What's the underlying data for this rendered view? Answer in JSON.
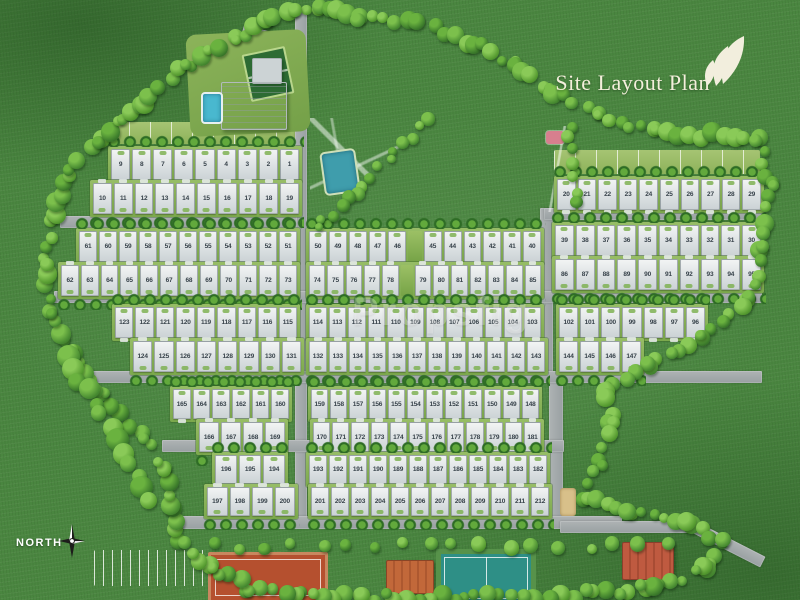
{
  "header": {
    "title": "Site Layout Plan"
  },
  "watermark": "Propsfig",
  "compass": {
    "label": "NORTH"
  },
  "colors": {
    "grass": "#4a8640",
    "road": "#9aa0a2",
    "plot": "#e3e8e9",
    "tree_dark": "#2f6a24",
    "tree_light": "#5fa83a",
    "title_text": "#f4efdc",
    "pool": "#49b8cf",
    "clay_court": "#b5502f",
    "green_court": "#2e8f86",
    "flower_bed": "#d77f8e"
  },
  "site": {
    "total_plots": 212,
    "rows": [
      {
        "x": 108,
        "y": 146,
        "w": 190,
        "h": 33,
        "dir": "up",
        "plots": [
          "9",
          "8",
          "7",
          "6",
          "5",
          "4",
          "3",
          "2",
          "1"
        ]
      },
      {
        "x": 90,
        "y": 180,
        "w": 208,
        "h": 33,
        "dir": "down",
        "plots": [
          "10",
          "11",
          "12",
          "13",
          "14",
          "15",
          "16",
          "17",
          "18",
          "19"
        ]
      },
      {
        "x": 554,
        "y": 176,
        "w": 206,
        "h": 33,
        "dir": "up",
        "plots": [
          "20",
          "21",
          "22",
          "23",
          "24",
          "25",
          "26",
          "27",
          "28",
          "29"
        ]
      },
      {
        "x": 76,
        "y": 228,
        "w": 220,
        "h": 33,
        "dir": "up",
        "plots": [
          "61",
          "60",
          "59",
          "58",
          "57",
          "56",
          "55",
          "54",
          "53",
          "52",
          "51"
        ]
      },
      {
        "x": 58,
        "y": 262,
        "w": 238,
        "h": 33,
        "dir": "down",
        "plots": [
          "62",
          "63",
          "64",
          "65",
          "66",
          "67",
          "68",
          "69",
          "70",
          "71",
          "72",
          "73"
        ]
      },
      {
        "x": 306,
        "y": 228,
        "w": 234,
        "h": 33,
        "dir": "up",
        "plots": [
          "50",
          "49",
          "48",
          "47",
          "46",
          null,
          "45",
          "44",
          "43",
          "42",
          "41",
          "40"
        ]
      },
      {
        "x": 306,
        "y": 262,
        "w": 234,
        "h": 33,
        "dir": "down",
        "plots": [
          "74",
          "75",
          "76",
          "77",
          "78",
          null,
          "79",
          "80",
          "81",
          "82",
          "83",
          "84",
          "85"
        ]
      },
      {
        "x": 552,
        "y": 222,
        "w": 208,
        "h": 33,
        "dir": "up",
        "plots": [
          "39",
          "38",
          "37",
          "36",
          "35",
          "34",
          "33",
          "32",
          "31",
          "30"
        ]
      },
      {
        "x": 552,
        "y": 256,
        "w": 208,
        "h": 33,
        "dir": "down",
        "plots": [
          "86",
          "87",
          "88",
          "89",
          "90",
          "91",
          "92",
          "93",
          "94",
          "95"
        ]
      },
      {
        "x": 112,
        "y": 304,
        "w": 184,
        "h": 33,
        "dir": "up",
        "plots": [
          "123",
          "122",
          "121",
          "120",
          "119",
          "118",
          "117",
          "116",
          "115"
        ]
      },
      {
        "x": 130,
        "y": 338,
        "w": 170,
        "h": 33,
        "dir": "down",
        "plots": [
          "124",
          "125",
          "126",
          "127",
          "128",
          "129",
          "130",
          "131"
        ]
      },
      {
        "x": 306,
        "y": 304,
        "w": 234,
        "h": 33,
        "dir": "up",
        "plots": [
          "114",
          "113",
          "112",
          "111",
          "110",
          "109",
          "108",
          "107",
          "106",
          "105",
          "104",
          "103"
        ]
      },
      {
        "x": 306,
        "y": 338,
        "w": 238,
        "h": 33,
        "dir": "down",
        "plots": [
          "132",
          "133",
          "134",
          "135",
          "136",
          "137",
          "138",
          "139",
          "140",
          "141",
          "142",
          "143"
        ]
      },
      {
        "x": 556,
        "y": 304,
        "w": 148,
        "h": 33,
        "dir": "up",
        "plots": [
          "102",
          "101",
          "100",
          "99",
          "98",
          "97",
          "96"
        ]
      },
      {
        "x": 556,
        "y": 338,
        "w": 84,
        "h": 33,
        "dir": "down",
        "plots": [
          "144",
          "145",
          "146",
          "147"
        ]
      },
      {
        "x": 170,
        "y": 386,
        "w": 118,
        "h": 32,
        "dir": "up",
        "plots": [
          "165",
          "164",
          "163",
          "162",
          "161",
          "160"
        ]
      },
      {
        "x": 196,
        "y": 419,
        "w": 88,
        "h": 32,
        "dir": "down",
        "plots": [
          "166",
          "167",
          "168",
          "169"
        ]
      },
      {
        "x": 308,
        "y": 386,
        "w": 230,
        "h": 32,
        "dir": "up",
        "plots": [
          "159",
          "158",
          "157",
          "156",
          "155",
          "154",
          "153",
          "152",
          "151",
          "150",
          "149",
          "148"
        ]
      },
      {
        "x": 310,
        "y": 419,
        "w": 230,
        "h": 32,
        "dir": "down",
        "plots": [
          "170",
          "171",
          "172",
          "173",
          "174",
          "175",
          "176",
          "177",
          "178",
          "179",
          "180",
          "181"
        ]
      },
      {
        "x": 212,
        "y": 452,
        "w": 72,
        "h": 31,
        "dir": "up",
        "plots": [
          "196",
          "195",
          "194"
        ]
      },
      {
        "x": 204,
        "y": 484,
        "w": 90,
        "h": 31,
        "dir": "down",
        "plots": [
          "197",
          "198",
          "199",
          "200"
        ]
      },
      {
        "x": 306,
        "y": 452,
        "w": 240,
        "h": 31,
        "dir": "up",
        "plots": [
          "193",
          "192",
          "191",
          "190",
          "189",
          "188",
          "187",
          "186",
          "185",
          "184",
          "183",
          "182"
        ]
      },
      {
        "x": 308,
        "y": 484,
        "w": 240,
        "h": 31,
        "dir": "down",
        "plots": [
          "201",
          "202",
          "203",
          "204",
          "205",
          "206",
          "207",
          "208",
          "209",
          "210",
          "211",
          "212"
        ]
      }
    ]
  }
}
